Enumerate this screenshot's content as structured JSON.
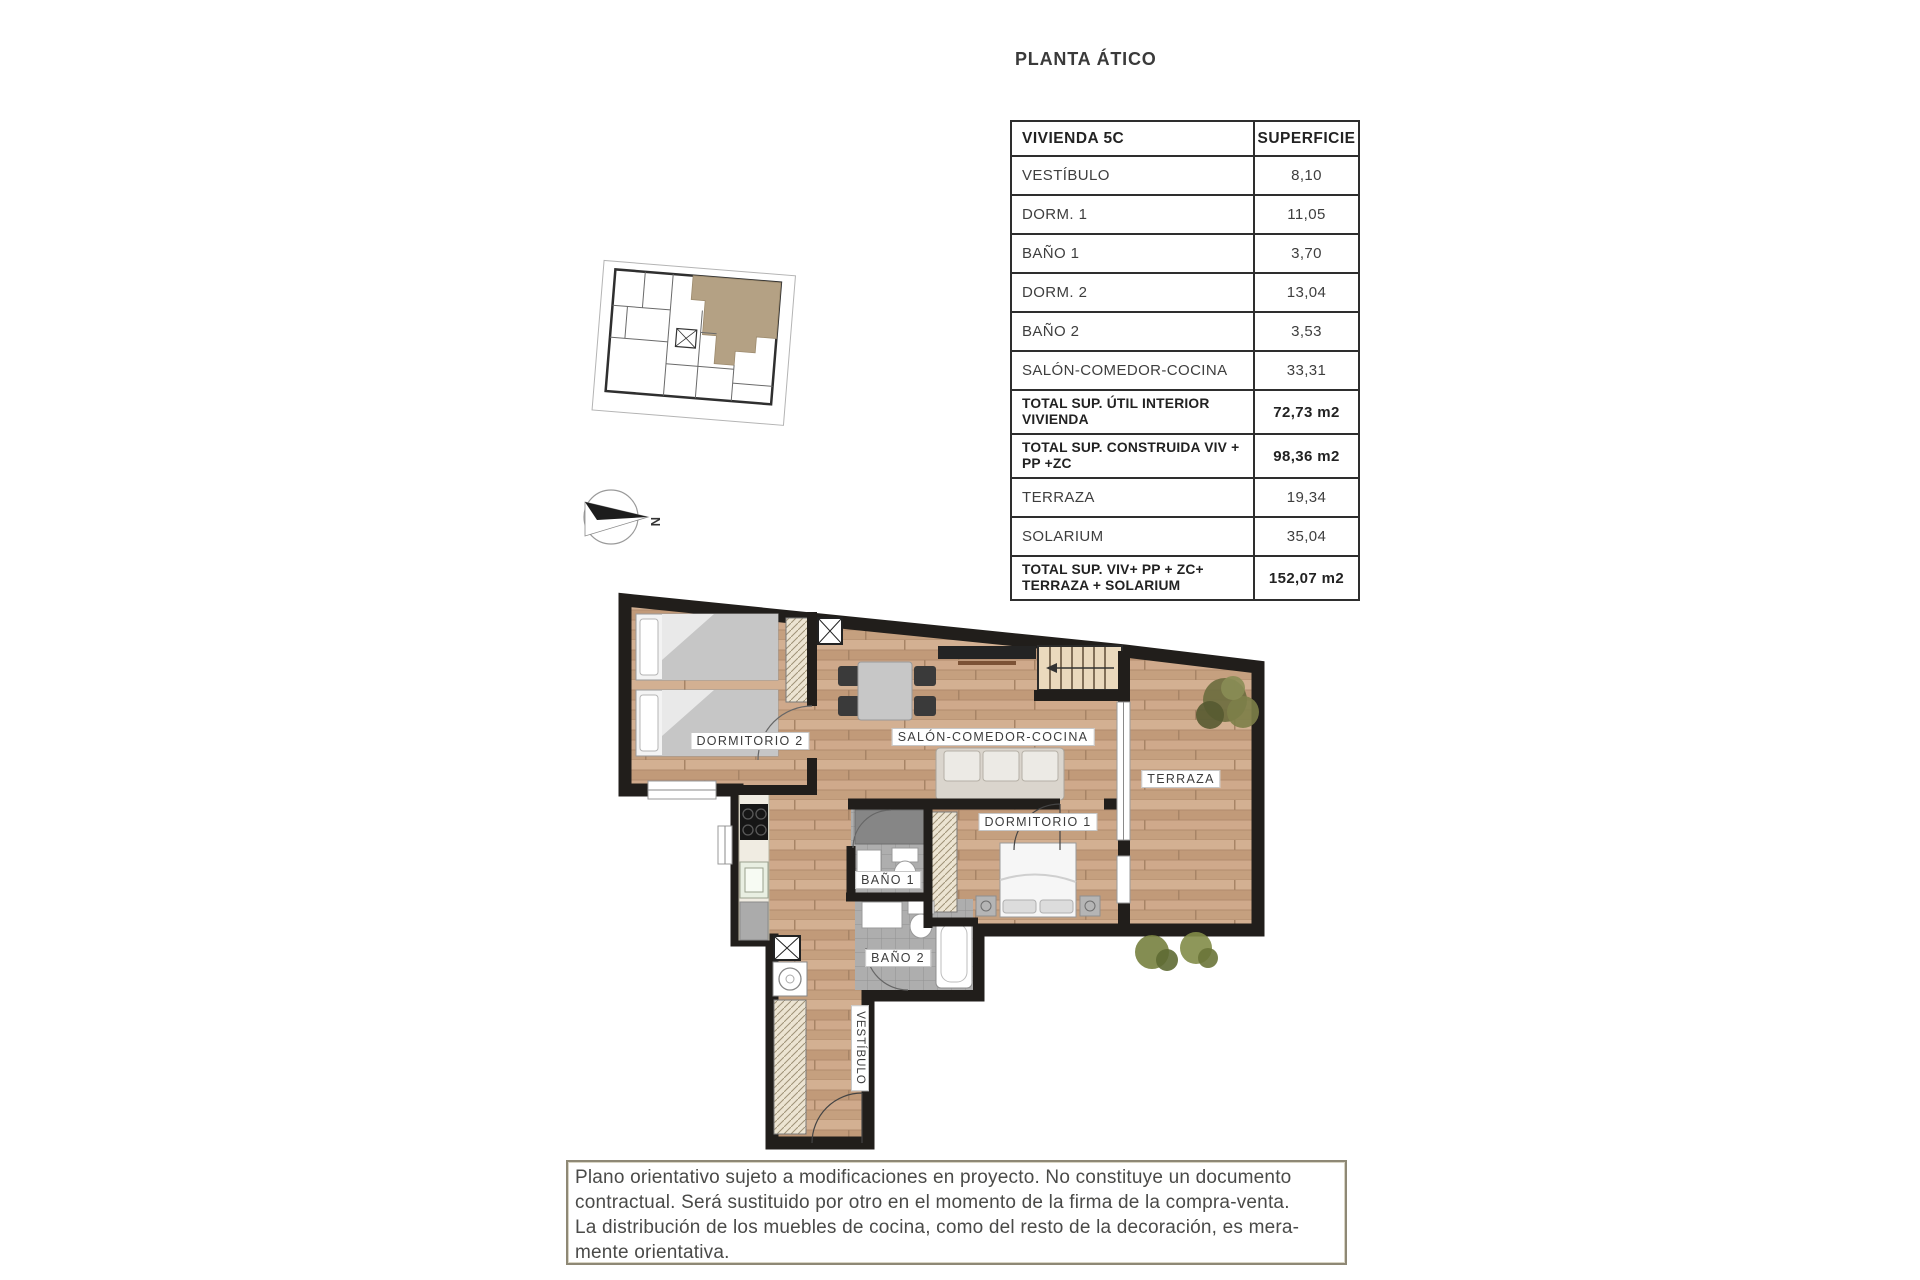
{
  "page": {
    "title": "PLANTA ÁTICO"
  },
  "table": {
    "rows": [
      {
        "type": "header",
        "label": "VIVIENDA 5C",
        "value": "SUPERFICIE"
      },
      {
        "type": "item",
        "label": "VESTÍBULO",
        "value": "8,10"
      },
      {
        "type": "item",
        "label": "DORM. 1",
        "value": "11,05"
      },
      {
        "type": "item",
        "label": "BAÑO 1",
        "value": "3,70"
      },
      {
        "type": "item",
        "label": "DORM. 2",
        "value": "13,04"
      },
      {
        "type": "item",
        "label": "BAÑO 2",
        "value": "3,53"
      },
      {
        "type": "item",
        "label": "SALÓN-COMEDOR-COCINA",
        "value": "33,31"
      },
      {
        "type": "total",
        "label": "TOTAL SUP. ÚTIL INTERIOR VIVIENDA",
        "value": "72,73 m2"
      },
      {
        "type": "total",
        "label": "TOTAL SUP. CONSTRUIDA VIV + PP +ZC",
        "value": "98,36 m2"
      },
      {
        "type": "item",
        "label": "TERRAZA",
        "value": "19,34"
      },
      {
        "type": "item",
        "label": "SOLARIUM",
        "value": "35,04"
      },
      {
        "type": "total",
        "label": "TOTAL SUP. VIV+ PP + ZC+ TERRAZA + SOLARIUM",
        "value": "152,07 m2"
      }
    ]
  },
  "plan": {
    "labels": {
      "dormitorio2": "DORMITORIO 2",
      "salon": "SALÓN-COMEDOR-COCINA",
      "terraza": "TERRAZA",
      "dormitorio1": "DORMITORIO 1",
      "bano1": "BAÑO 1",
      "bano2": "BAÑO 2",
      "vestibulo": "VESTÍBULO"
    }
  },
  "compass": {
    "north_label": "N"
  },
  "disclaimer": {
    "lines": [
      "Plano orientativo sujeto a modificaciones en proyecto. No constituye un documento",
      "contractual. Será sustituido por otro en el momento de la firma de la compra-venta.",
      "La distribución de los muebles de cocina, como del resto de la decoración, es mera-",
      "mente orientativa."
    ]
  },
  "colors": {
    "wall": "#211e1b",
    "wood_floor": "#c9a282",
    "unit_highlight": "#b4a184",
    "disclaimer_border": "#8e8875"
  }
}
